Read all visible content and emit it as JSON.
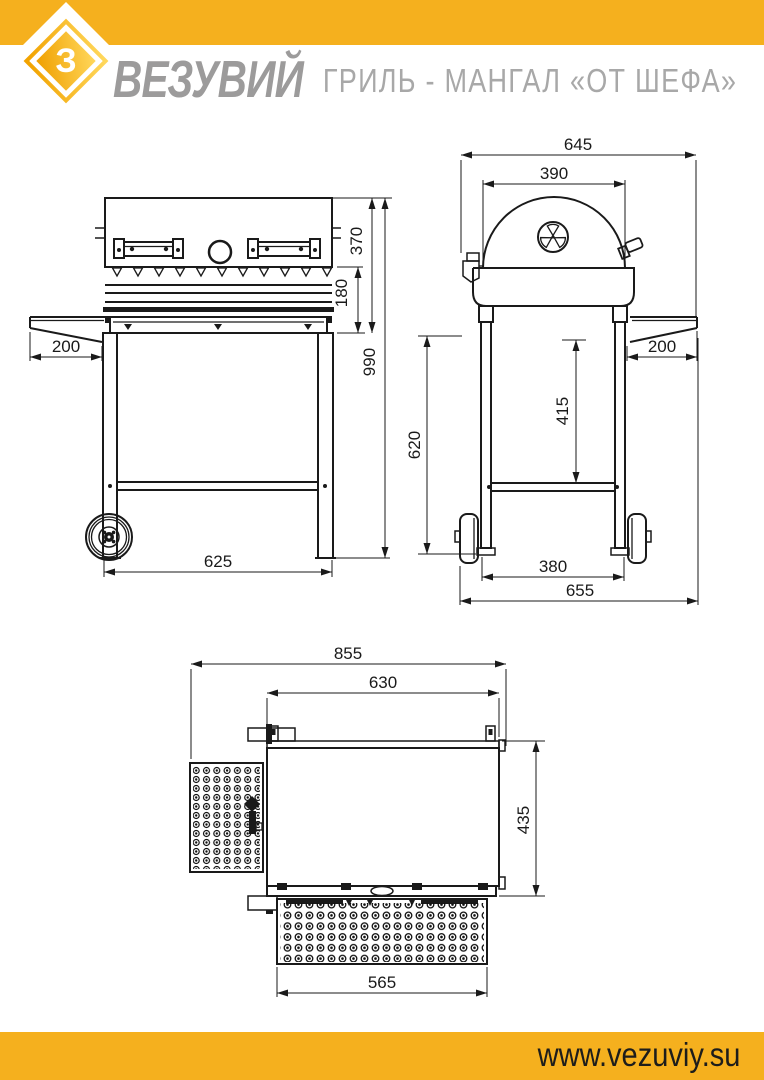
{
  "header": {
    "brand": "ВЕЗУВИЙ",
    "logo_letter": "З",
    "title": "ГРИЛЬ - МАНГАЛ «ОТ ШЕФА»"
  },
  "footer": {
    "url": "www.vezuviy.su"
  },
  "colors": {
    "brand_yellow": "#F5B01E",
    "line_black": "#1A1A1A",
    "brand_gray": "#9C9B9B",
    "title_gray": "#A8A8A8"
  },
  "views": {
    "front": {
      "name": "вид спереди",
      "dims": {
        "shelf_depth": "200",
        "firebox_height": "370",
        "lower_band_height": "180",
        "total_height": "990",
        "leg_span": "625"
      }
    },
    "side": {
      "name": "вид сбоку",
      "dims": {
        "overall_top_width": "645",
        "dome_width": "390",
        "shelf_depth": "200",
        "shelf_to_crossbar": "415",
        "leg_height": "620",
        "wheelbase": "380",
        "overall_base_width": "655"
      }
    },
    "top": {
      "name": "вид сверху",
      "dims": {
        "overall_width": "855",
        "body_width": "630",
        "body_depth": "435",
        "front_shelf_width": "565"
      }
    }
  }
}
